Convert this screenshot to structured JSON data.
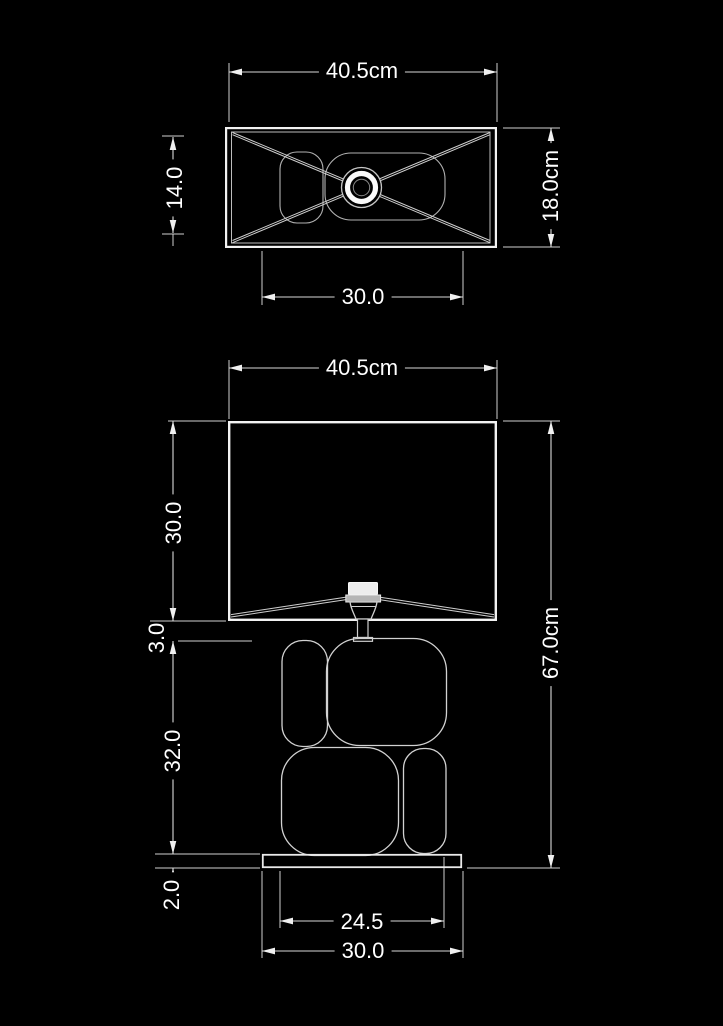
{
  "page": {
    "background": "#000000",
    "text_color": "#ffffff",
    "line_color": "#e8e8e8",
    "title": "Table lamp dimension drawing"
  },
  "top_view": {
    "name": "lampshade top view",
    "dim_width": "40.5cm",
    "dim_inner_depth": "14.0",
    "dim_depth": "18.0cm",
    "dim_body_width": "30.0"
  },
  "front_view": {
    "name": "lamp front view",
    "dim_width": "40.5cm",
    "dim_shade_height": "30.0",
    "dim_gap": "3.0",
    "dim_body_height": "32.0",
    "dim_base_height": "2.0",
    "dim_total_height": "67.0cm",
    "dim_body_width": "24.5",
    "dim_base_width": "30.0"
  }
}
